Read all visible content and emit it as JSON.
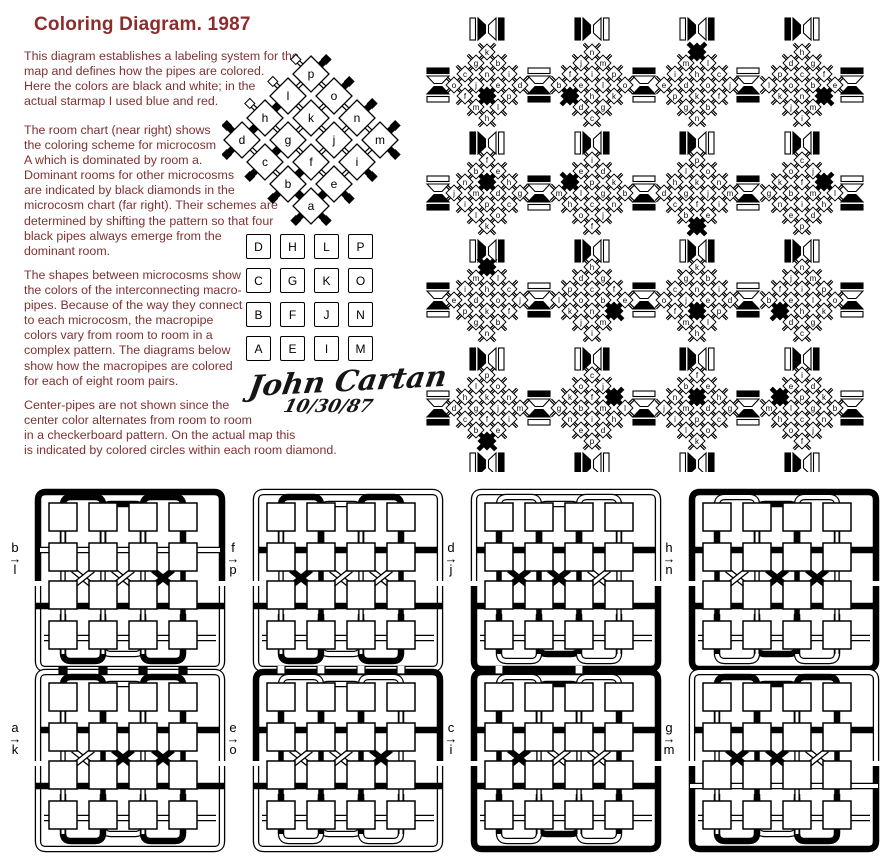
{
  "title": "Coloring Diagram.  1987",
  "colors": {
    "ink": "#000000",
    "title_red": "#8e2c2c",
    "text_red": "#7f3131",
    "background": "#ffffff"
  },
  "paragraphs": [
    "This diagram establishes a labeling system for the\nmap and defines how the pipes are colored.\nHere the colors are black and white; in the\nactual starmap I used blue and red.",
    "The room chart (near right) shows\nthe coloring scheme for microcosm\nA which is dominated by room a.\nDominant rooms for other microcosms\nare indicated by black diamonds in the\nmicrocosm chart (far right).  Their schemes are\ndetermined by shifting the pattern so that four\nblack pipes always emerge from the\ndominant room.",
    "The shapes between microcosms show\nthe colors of the interconnecting macro-\npipes.  Because of the way they connect\nto each microcosm, the macropipe\ncolors vary from room to room in a\ncomplex pattern.  The diagrams below\nshow how the macropipes are colored\nfor each of eight room pairs.",
    "Center-pipes are not shown since the\ncenter color alternates from room to room\nin a checkerboard pattern.  On the actual map this\nis indicated by colored circles within each room diamond."
  ],
  "room_chart": {
    "grid": [
      "dhlp",
      "cgko",
      "bfjn",
      "aeim"
    ],
    "black_internal": [
      "d-h",
      "h-l",
      "c-g",
      "b-f",
      "a-e",
      "a-b"
    ],
    "outer_stubs": [
      {
        "room": "d",
        "dir": "nw",
        "black": true
      },
      {
        "room": "h",
        "dir": "nw",
        "black": false
      },
      {
        "room": "l",
        "dir": "nw",
        "black": false
      },
      {
        "room": "p",
        "dir": "nw",
        "black": false
      },
      {
        "room": "p",
        "dir": "ne",
        "black": true
      },
      {
        "room": "o",
        "dir": "ne",
        "black": true
      },
      {
        "room": "n",
        "dir": "ne",
        "black": true
      },
      {
        "room": "m",
        "dir": "ne",
        "black": true
      },
      {
        "room": "m",
        "dir": "se",
        "black": true
      },
      {
        "room": "i",
        "dir": "se",
        "black": true
      },
      {
        "room": "e",
        "dir": "se",
        "black": true
      },
      {
        "room": "a",
        "dir": "se",
        "black": true
      },
      {
        "room": "a",
        "dir": "sw",
        "black": true
      },
      {
        "room": "b",
        "dir": "sw",
        "black": true
      },
      {
        "room": "c",
        "dir": "sw",
        "black": true
      },
      {
        "room": "d",
        "dir": "sw",
        "black": true
      }
    ]
  },
  "letter_grid": {
    "rows": [
      [
        "D",
        "H",
        "L",
        "P"
      ],
      [
        "C",
        "G",
        "K",
        "O"
      ],
      [
        "B",
        "F",
        "J",
        "N"
      ],
      [
        "A",
        "E",
        "I",
        "M"
      ]
    ],
    "origin_x": 246,
    "origin_y": 234,
    "pitch": 34
  },
  "signature": {
    "name": "John Cartan",
    "date": "10/30/87"
  },
  "microcosm_chart": {
    "clusters": [
      {
        "row": 1,
        "col": 1,
        "diamond_rows": [
          "k",
          "gb",
          "cni",
          "ojed",
          "f*p",
          "ml",
          "h"
        ]
      },
      {
        "row": 1,
        "col": 2,
        "diamond_rows": [
          "n",
          "jm",
          "fip",
          "belo",
          "*hk",
          "dg",
          "c"
        ]
      },
      {
        "row": 1,
        "col": 3,
        "diamond_rows": [
          "*",
          "ml",
          "ihc",
          "edoj",
          "pkf",
          "gb",
          "n"
        ]
      },
      {
        "row": 1,
        "col": 4,
        "diamond_rows": [
          "h",
          "dg",
          "pcf",
          "lobe",
          "kn*",
          "jm",
          "i"
        ]
      },
      {
        "row": 2,
        "col": 1,
        "diamond_rows": [
          "f",
          "be",
          "n*h",
          "jmdg",
          "ipc",
          "lo",
          "k"
        ]
      },
      {
        "row": 2,
        "col": 2,
        "diamond_rows": [
          "i",
          "ed",
          "*pk",
          "mlgb",
          "hcn",
          "oj",
          "f"
        ]
      },
      {
        "row": 2,
        "col": 3,
        "diamond_rows": [
          "p",
          "lo",
          "hkn",
          "dgjm",
          "cfi",
          "be",
          "*"
        ]
      },
      {
        "row": 2,
        "col": 4,
        "diamond_rows": [
          "c",
          "oj",
          "kf*",
          "gbml",
          "nih",
          "ed",
          "p"
        ]
      },
      {
        "row": 3,
        "col": 1,
        "diamond_rows": [
          "*",
          "ml",
          "ihc",
          "edoj",
          "pkf",
          "gb",
          "n"
        ]
      },
      {
        "row": 3,
        "col": 2,
        "diamond_rows": [
          "h",
          "dg",
          "pcf",
          "lobe",
          "kn*",
          "jm",
          "i"
        ]
      },
      {
        "row": 3,
        "col": 3,
        "diamond_rows": [
          "k",
          "gb",
          "cni",
          "ojed",
          "f*p",
          "ml",
          "h"
        ]
      },
      {
        "row": 3,
        "col": 4,
        "diamond_rows": [
          "n",
          "jm",
          "fip",
          "belo",
          "*hk",
          "dg",
          "c"
        ]
      },
      {
        "row": 4,
        "col": 1,
        "diamond_rows": [
          "p",
          "lo",
          "hkn",
          "dgjm",
          "cfi",
          "be",
          "*"
        ]
      },
      {
        "row": 4,
        "col": 2,
        "diamond_rows": [
          "c",
          "oj",
          "kf*",
          "gbml",
          "nih",
          "ed",
          "p"
        ]
      },
      {
        "row": 4,
        "col": 3,
        "diamond_rows": [
          "f",
          "be",
          "n*h",
          "jmdg",
          "ipc",
          "lo",
          "k"
        ]
      },
      {
        "row": 4,
        "col": 4,
        "diamond_rows": [
          "i",
          "ed",
          "*pk",
          "mlgb",
          "hcn",
          "oj",
          "f"
        ]
      }
    ],
    "black_marker": "*",
    "v_glyphs": [
      [
        "WBWB",
        "BBWW",
        "WBWB",
        "BBWW"
      ],
      [
        "BBWW",
        "WBWB",
        "BBWW",
        "WBWB"
      ],
      [
        "WBWB",
        "BBWW",
        "WBWB",
        "BBWW"
      ],
      [
        "BBWW",
        "WBWB",
        "BBWW",
        "WBWB"
      ],
      [
        "WBWB",
        "BBWW",
        "WBWB",
        "BBWW"
      ]
    ],
    "h_glyphs": [
      [
        "BWBW",
        "WWBB",
        "BWBW",
        "WWBB"
      ],
      [
        "WWBB",
        "BWBW",
        "WWBB",
        "BWBW"
      ],
      [
        "BWBW",
        "WWBB",
        "BWBW",
        "WWBB"
      ],
      [
        "WWBB",
        "BWBW",
        "WWBB",
        "BWBW"
      ],
      [
        "BWBW",
        "WWBB",
        "BWBW",
        "WWBB"
      ]
    ]
  },
  "pipe_diagrams": [
    {
      "from": "b",
      "to": "l",
      "arrow": "→",
      "top_u": "BBBB",
      "verticals": "WWWB",
      "x_marks": "WWB",
      "h_bands": "WBW",
      "bottom_u": "BWBW",
      "top_stubs": ""
    },
    {
      "from": "f",
      "to": "p",
      "arrow": "→",
      "top_u": "BWBW",
      "verticals": "WBWB",
      "x_marks": "BWW",
      "h_bands": "BBW",
      "bottom_u": "BWBW",
      "top_stubs": ""
    },
    {
      "from": "d",
      "to": "j",
      "arrow": "→",
      "top_u": "WWWW",
      "verticals": "BBBW",
      "x_marks": "BBW",
      "h_bands": "BBW",
      "bottom_u": "WBWB",
      "top_stubs": ""
    },
    {
      "from": "h",
      "to": "n",
      "arrow": "→",
      "top_u": "WBWB",
      "verticals": "BWBW",
      "x_marks": "WBB",
      "h_bands": "BBW",
      "bottom_u": "WBWB",
      "top_stubs": ""
    },
    {
      "from": "a",
      "to": "k",
      "arrow": "→",
      "top_u": "BWBW",
      "verticals": "WBWB",
      "x_marks": "WBB",
      "h_bands": "BBW",
      "bottom_u": "BWBW",
      "top_stubs": "BBBB"
    },
    {
      "from": "e",
      "to": "o",
      "arrow": "→",
      "top_u": "WWWB",
      "verticals": "BBBW",
      "x_marks": "WWB",
      "h_bands": "BBW",
      "bottom_u": "WWWW",
      "top_stubs": "WWWW"
    },
    {
      "from": "c",
      "to": "i",
      "arrow": "→",
      "top_u": "WBWB",
      "verticals": "BWWB",
      "x_marks": "BWW",
      "h_bands": "BBW",
      "bottom_u": "WBWB",
      "top_stubs": "WBWB"
    },
    {
      "from": "g",
      "to": "m",
      "arrow": "→",
      "top_u": "BBBW",
      "verticals": "WBWB",
      "x_marks": "BBW",
      "h_bands": "BWW",
      "bottom_u": "BWBB",
      "top_stubs": ""
    }
  ]
}
